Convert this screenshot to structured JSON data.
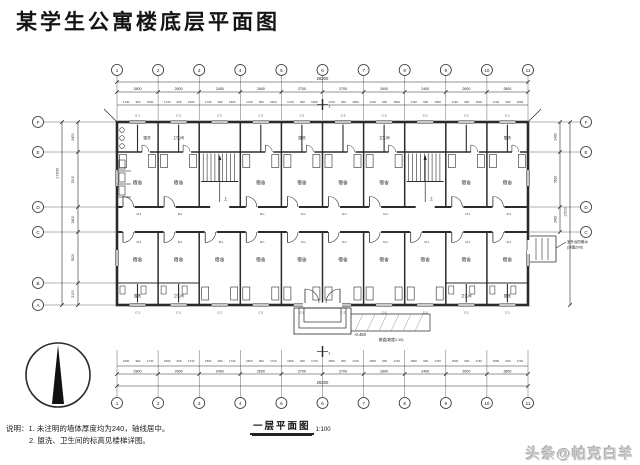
{
  "page": {
    "title": "某学生公寓楼底层平面图",
    "watermark": "头条@帕克白羊"
  },
  "notes": {
    "label": "说明：",
    "line1": "1. 未注明的墙体厚度均为240，轴线居中。",
    "line2": "2. 盥洗、卫生间的标高见楼梯详图。"
  },
  "drawing_title": {
    "text": "一层平面图",
    "scale": "1:100"
  },
  "plan": {
    "grid_cols": [
      "1",
      "2",
      "3",
      "4",
      "5",
      "6",
      "7",
      "8",
      "9",
      "10",
      "11"
    ],
    "grid_rows": [
      "F",
      "E",
      "D",
      "C",
      "B",
      "A"
    ],
    "grid_rows_right": [
      "F",
      "E",
      "D",
      "C"
    ],
    "bay_dims": [
      "2800",
      "2600",
      "2400",
      "2600",
      "2700",
      "2700",
      "2600",
      "2400",
      "2600",
      "2800"
    ],
    "detail_dims": [
      "1740",
      "900",
      "1500"
    ],
    "total_width": "26200",
    "row_dims": [
      "2400",
      "5100",
      "2400",
      "5200",
      "2100"
    ],
    "total_height": "17200",
    "room_labels": {
      "dorm": "宿舍",
      "wash": "盥洗",
      "wc": "卫生间",
      "stair_up": "上"
    },
    "codes": {
      "window": "C-2",
      "window_alt": "C-1",
      "door": "M-1"
    },
    "annotations": {
      "entrance_level": "-0.450",
      "ramp": "坡道(坡度1:10)",
      "side_note1": "室外台阶散水",
      "side_note2": "(详图Z/06)",
      "section_mark": "1"
    }
  }
}
